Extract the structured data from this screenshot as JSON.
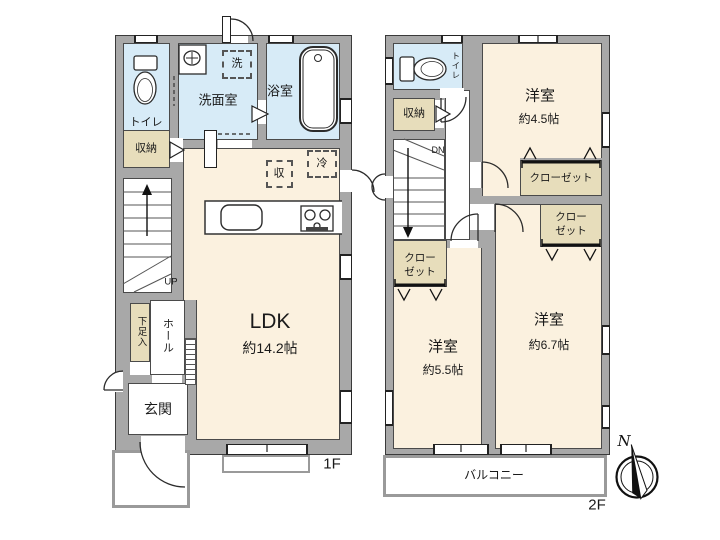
{
  "compass": {
    "n": "N"
  },
  "f1": {
    "floor_label": "1F",
    "toilet": "トイレ",
    "washroom": "洗面室",
    "bath": "浴室",
    "washer": "洗",
    "storage": "収納",
    "up": "UP",
    "ldk_name": "LDK",
    "ldk_size": "約14.2帖",
    "stock": "収",
    "fridge": "冷",
    "hall": "ホール",
    "shoe_box": "下足入",
    "entrance": "玄関"
  },
  "f2": {
    "floor_label": "2F",
    "toilet": "トイレ",
    "storage": "収納",
    "dn": "DN",
    "room_small_name": "洋室",
    "room_small_size": "約4.5帖",
    "room_mid_name": "洋室",
    "room_mid_size": "約5.5帖",
    "room_large_name": "洋室",
    "room_large_size": "約6.7帖",
    "closet_small": "クローゼット",
    "closet_mid_l1": "クロー",
    "closet_mid_l2": "ゼット",
    "closet_large_l1": "クロー",
    "closet_large_l2": "ゼット",
    "balcony": "バルコニー"
  },
  "colors": {
    "wall": "#a8a8a8",
    "room_warm": "#fbf1df",
    "room_wet": "#d7ebf7",
    "storage": "#e7ddbb"
  }
}
